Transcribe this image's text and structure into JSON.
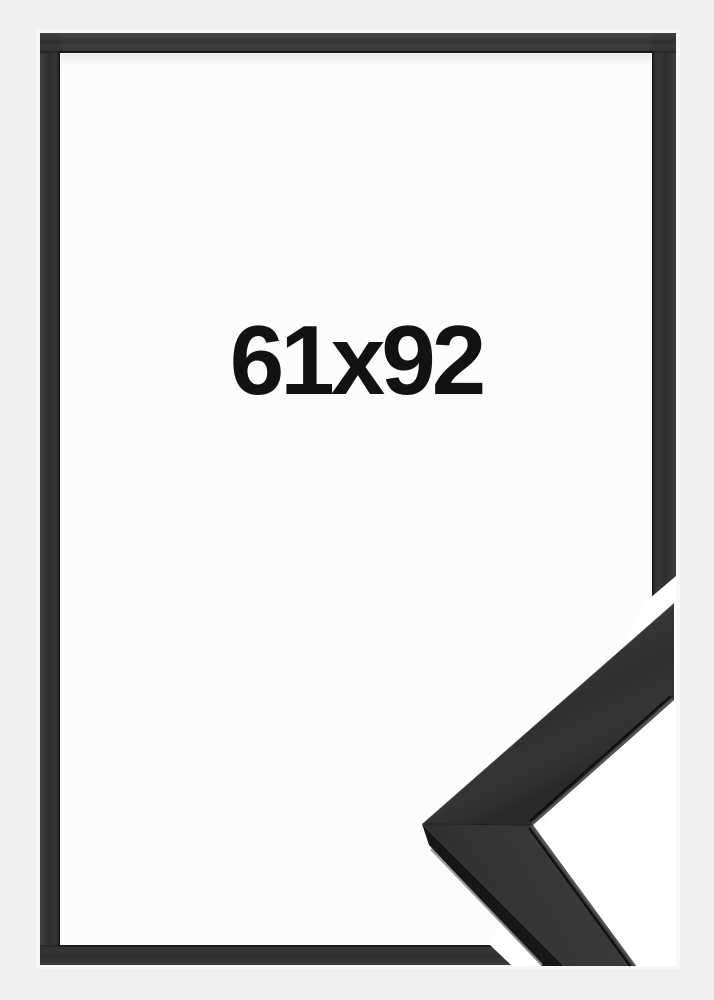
{
  "photo": {
    "size_label": "61x92"
  },
  "colors": {
    "page_background": "#f0f0f1",
    "outer_edge_highlight": "#f7f7f8",
    "frame_black": "#2e2e30",
    "frame_black_top": "#333335",
    "frame_inner_line": "#1b1b1d",
    "glass_area": "#fcfcfc",
    "cutout_white": "#ffffff",
    "label_text": "#121212",
    "moulding_surface": "#2f2f31",
    "moulding_side": "#17171a",
    "moulding_edge_highlight": "#8f8f93",
    "moulding_lip": "#55555a",
    "moulding_crease": "#0e0e10"
  }
}
